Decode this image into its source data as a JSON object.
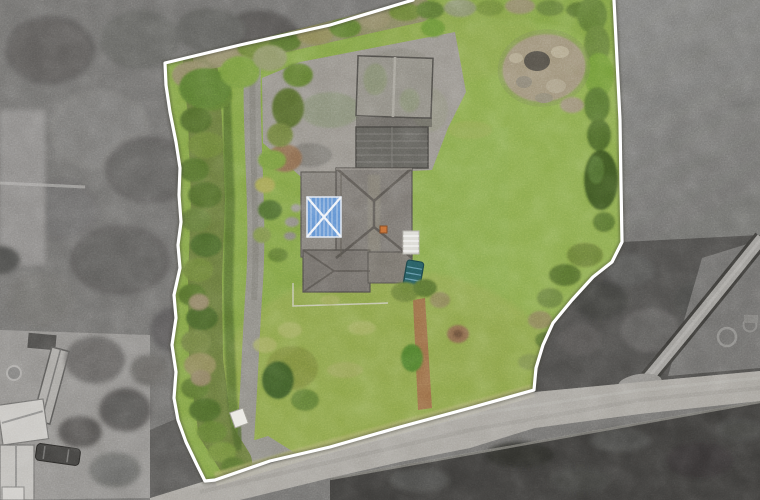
{
  "scene": {
    "type": "aerial-drone-photo",
    "subject": "Top-down drone photo of a detached bungalow and its gardens outlined by a white property boundary; the photo is desaturated to grayscale outside the boundary",
    "orientation": "top-down"
  },
  "boundary": {
    "line_color": "#ffffff",
    "style": "solid",
    "clipped_at_top_edge": true
  },
  "colors": {
    "boundary_line": "#ffffff",
    "lawn": "#7fa044",
    "lawn_light": "#8fae52",
    "lawn_lower": "#95a350",
    "lawn_pale": "#a6ad64",
    "hedge_dark": "#4c662c",
    "hedge_olive": "#6b8038",
    "scrub_tan": "#8f8866",
    "conifer": "#3c5524",
    "driveway": "#8d8b84",
    "yard_concrete": "#95918a",
    "dirt_patch": "#8a6a50",
    "roof_main": "#77736e",
    "roof_wing": "#807c76",
    "roof_shed": "#8d8a81",
    "greenhouse_dark": "#5e5d58",
    "lantern_blue": "#5e8fd0",
    "lantern_bars": "#eef2f8",
    "chimney_orange": "#c26a33",
    "car_teal": "#23575c",
    "conservatory_white": "#d9d8d2",
    "rough_patch": "#9c9077",
    "rough_dark": "#514d45",
    "path_brown": "#996747",
    "sign_white": "#e9e8e2",
    "woodland": "#6f6e6c",
    "field_gray": "#7b7b79",
    "scrub_dark": "#4b4a48",
    "road": "#a5a29c",
    "hedgerow_dark": "#3b3a38",
    "neighbor_lawn": "#8f8d8a",
    "neighbor_roof": "#c7c5c1",
    "neighbor_car": "#3f3e3c",
    "track": "#9b9995",
    "verge_pale": "#b3b0a4"
  },
  "features": {
    "inside_plot": [
      "main house with grey hipped roof",
      "blue glazed roof lantern",
      "white conservatory",
      "teal vehicle",
      "garage shed",
      "dark greenhouse roof",
      "concrete yard",
      "tarmac driveway",
      "upper lawn",
      "lower lawn",
      "perimeter hedges",
      "conifer tree",
      "rockery rough patch",
      "brown bark path",
      "round shrubs",
      "white gate panel"
    ],
    "outside_plot": [
      "bare winter woodland",
      "neighbouring house",
      "parked car",
      "barn outbuilding",
      "country road",
      "roadside hedgerow",
      "farm track",
      "ploughed field"
    ]
  }
}
